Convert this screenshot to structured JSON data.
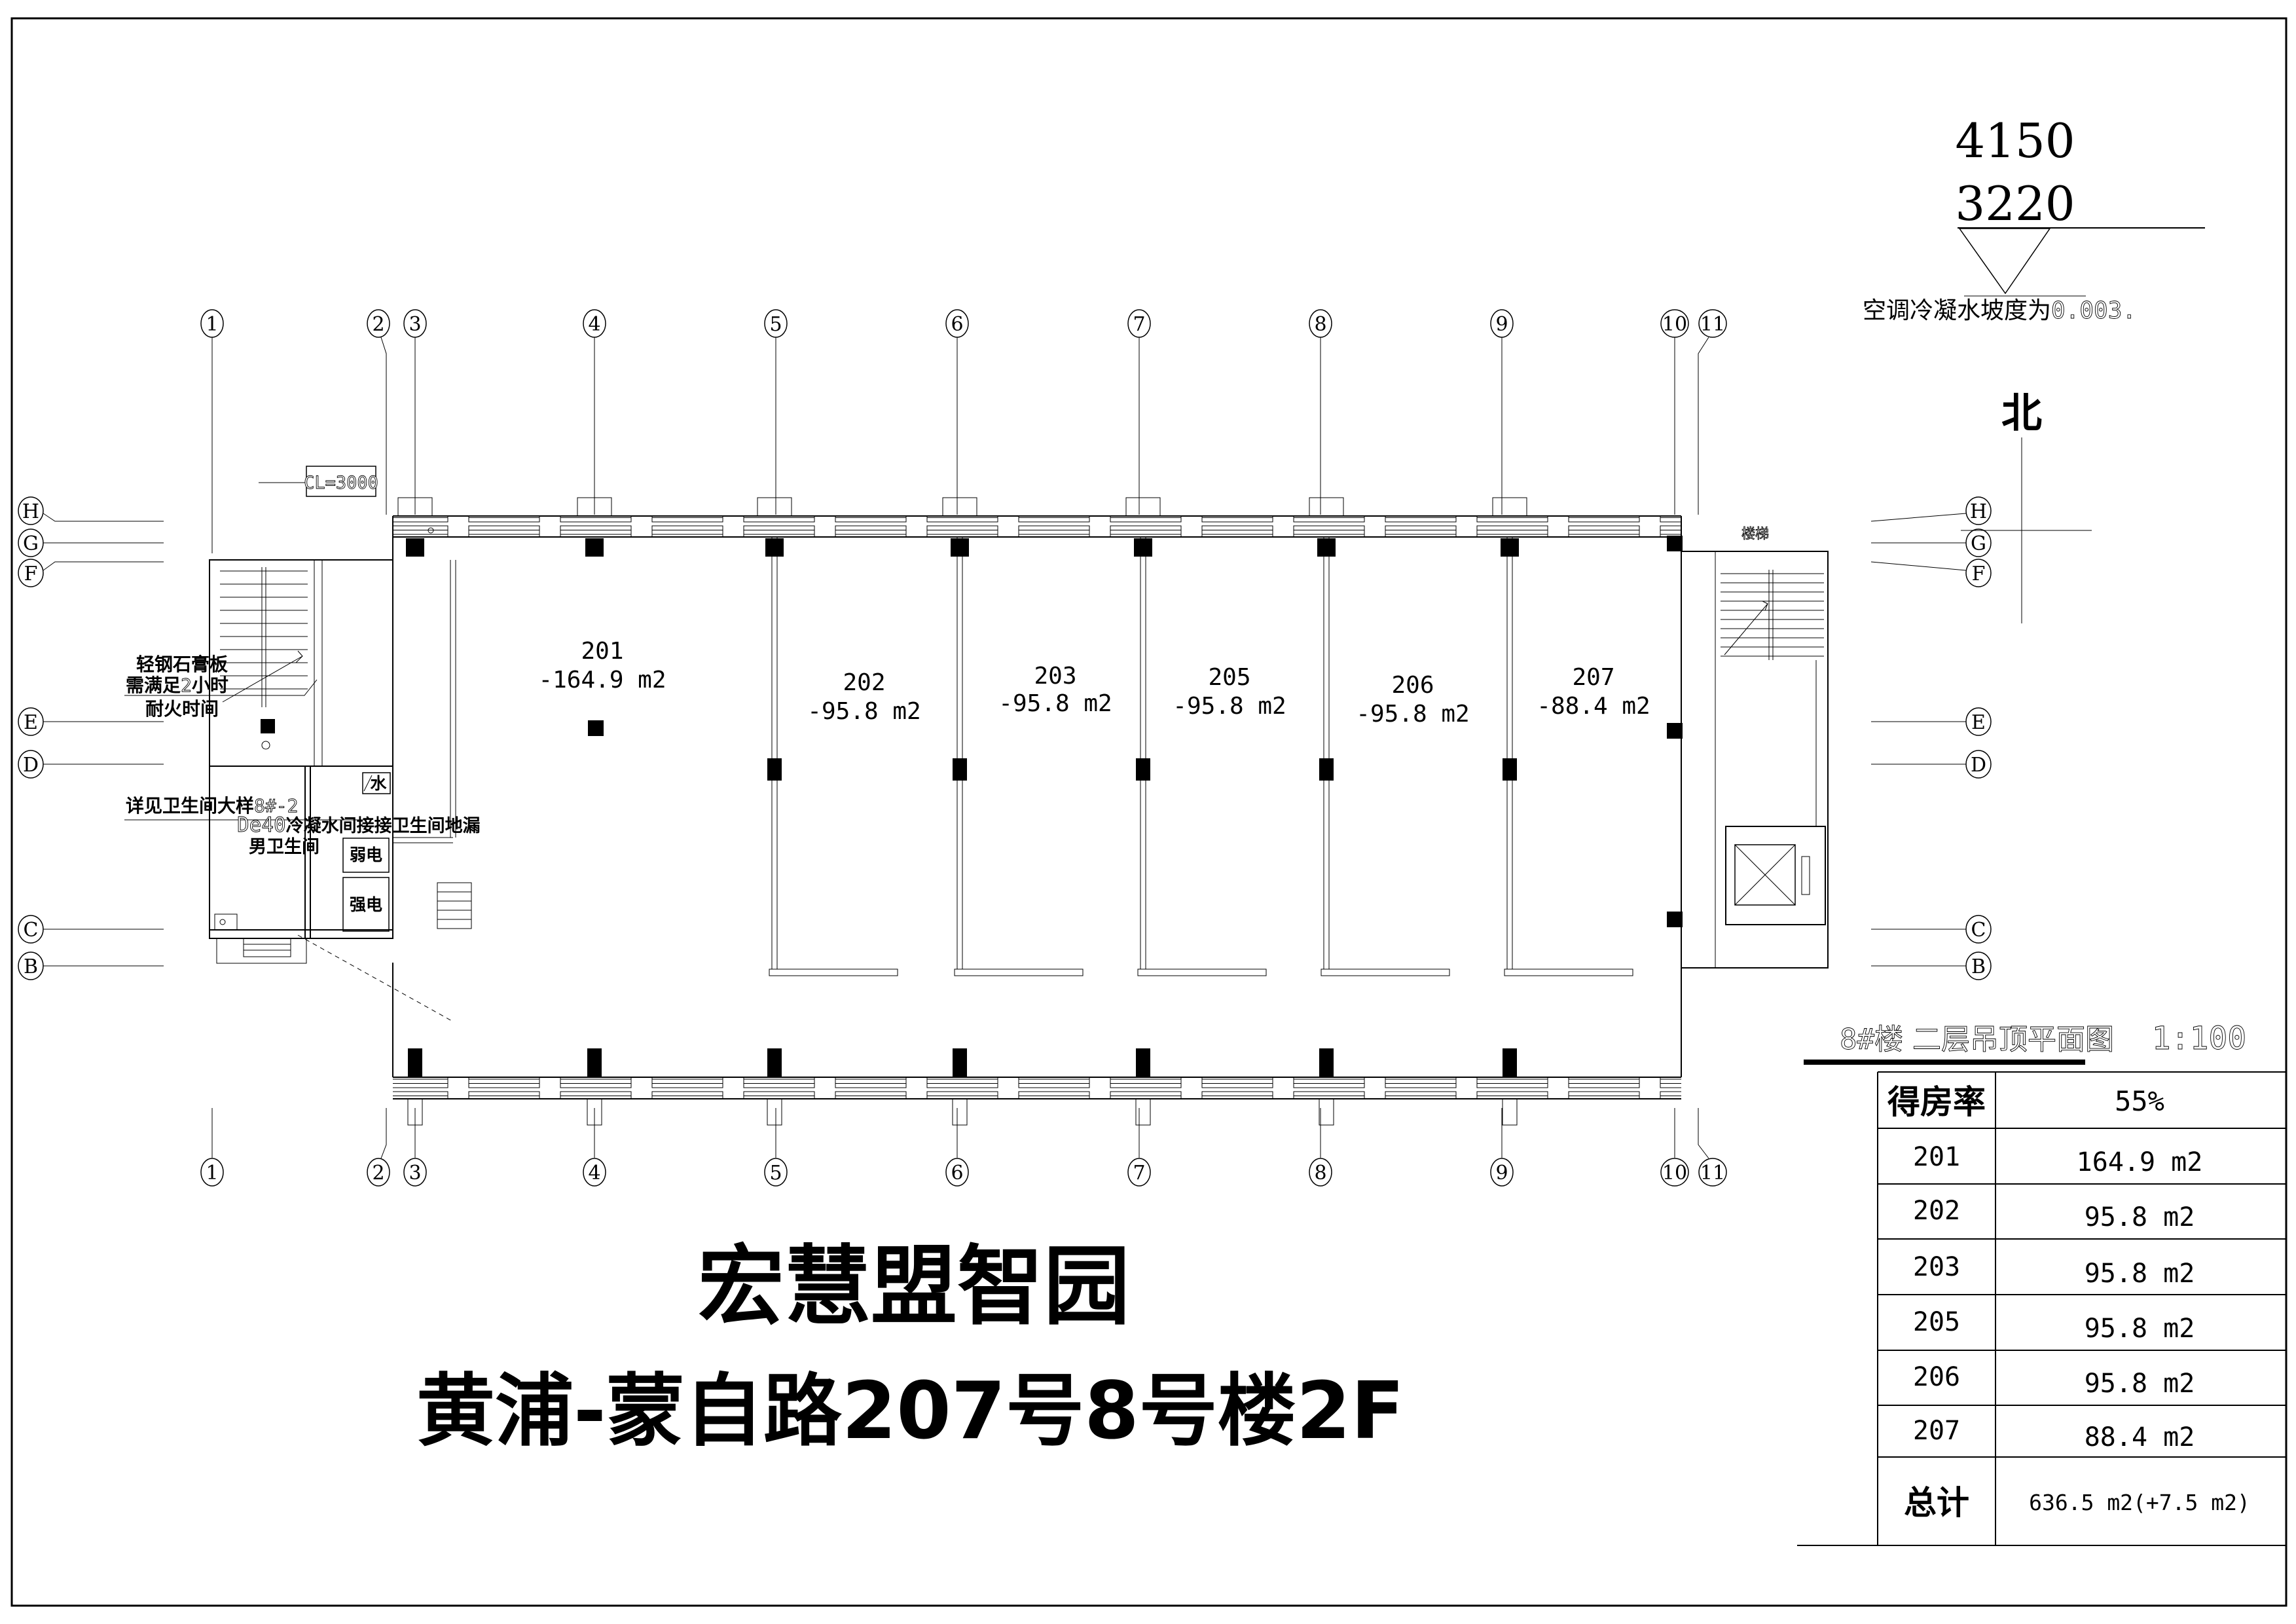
{
  "dimensions": {
    "dim_top": "4150",
    "dim_bottom": "3220"
  },
  "notes": {
    "slope_label": "空调冷凝水坡度为",
    "slope_value": "0.003.",
    "north": "北",
    "ceiling_level": "CL=3000",
    "stair": "楼梯",
    "water": "水"
  },
  "annotations": {
    "gypsum_line1": "轻钢石膏板",
    "gypsum_line2_pre": "需满足",
    "gypsum_line2_num": "2",
    "gypsum_line2_post": "小时",
    "gypsum_line3": "耐火时间",
    "bath_detail_pre": "详见卫生间大样",
    "bath_detail_num": "8#-2",
    "drain_pre": "De40",
    "drain_text": "冷凝水间接接卫生间地漏",
    "mens_bathroom": "男卫生间",
    "weak_power": "弱电",
    "strong_power": "强电"
  },
  "grid": {
    "columns": [
      "1",
      "2",
      "3",
      "4",
      "5",
      "6",
      "7",
      "8",
      "9",
      "10",
      "11"
    ],
    "rows": [
      "H",
      "G",
      "F",
      "E",
      "D",
      "C",
      "B"
    ]
  },
  "rooms": [
    {
      "id": "201",
      "area": "-164.9 m2"
    },
    {
      "id": "202",
      "area": "-95.8 m2"
    },
    {
      "id": "203",
      "area": "-95.8 m2"
    },
    {
      "id": "205",
      "area": "-95.8 m2"
    },
    {
      "id": "206",
      "area": "-95.8 m2"
    },
    {
      "id": "207",
      "area": "-88.4 m2"
    }
  ],
  "title_block": {
    "building": "8#楼",
    "drawing_title": "二层吊顶平面图",
    "scale": "1:100"
  },
  "table": {
    "header_label": "得房率",
    "header_value": "55%",
    "rows": [
      {
        "room": "201",
        "area": "164.9 m2"
      },
      {
        "room": "202",
        "area": "95.8 m2"
      },
      {
        "room": "203",
        "area": "95.8 m2"
      },
      {
        "room": "205",
        "area": "95.8 m2"
      },
      {
        "room": "206",
        "area": "95.8 m2"
      },
      {
        "room": "207",
        "area": "88.4 m2"
      }
    ],
    "total_label": "总计",
    "total_value": "636.5 m2(+7.5 m2)"
  },
  "footer": {
    "project": "宏慧盟智园",
    "address": "黄浦-蒙自路207号8号楼2F"
  },
  "colors": {
    "ink": "#000000",
    "paper": "#ffffff"
  }
}
